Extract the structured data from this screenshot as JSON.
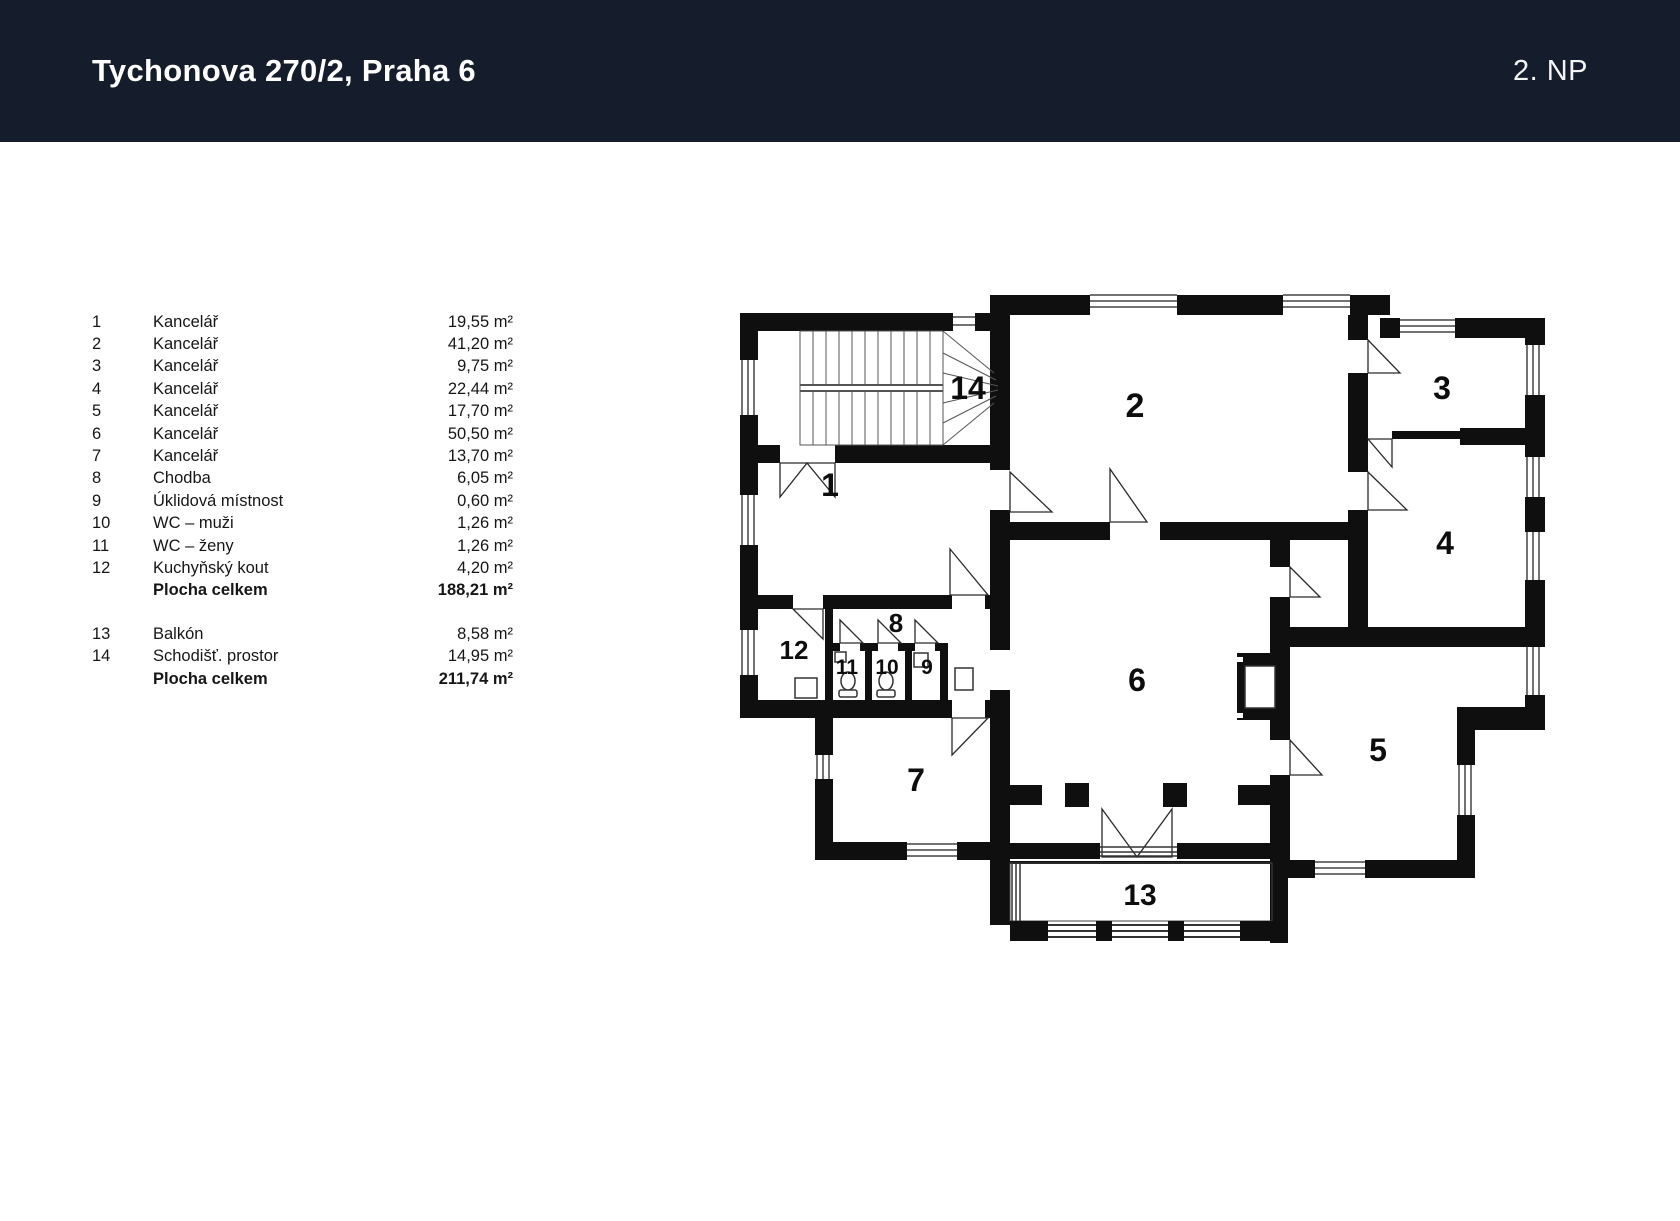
{
  "header": {
    "title": "Tychonova 270/2, Praha 6",
    "floor": "2. NP"
  },
  "legend": {
    "rows": [
      {
        "num": "1",
        "name": "Kancelář",
        "area": "19,55 m²"
      },
      {
        "num": "2",
        "name": "Kancelář",
        "area": "41,20 m²"
      },
      {
        "num": "3",
        "name": "Kancelář",
        "area": "9,75 m²"
      },
      {
        "num": "4",
        "name": "Kancelář",
        "area": "22,44 m²"
      },
      {
        "num": "5",
        "name": "Kancelář",
        "area": "17,70 m²"
      },
      {
        "num": "6",
        "name": "Kancelář",
        "area": "50,50 m²"
      },
      {
        "num": "7",
        "name": "Kancelář",
        "area": "13,70 m²"
      },
      {
        "num": "8",
        "name": "Chodba",
        "area": "6,05 m²"
      },
      {
        "num": "9",
        "name": "Úklidová místnost",
        "area": "0,60 m²"
      },
      {
        "num": "10",
        "name": "WC – muži",
        "area": "1,26 m²"
      },
      {
        "num": "11",
        "name": "WC – ženy",
        "area": "1,26 m²"
      },
      {
        "num": "12",
        "name": "Kuchyňský kout",
        "area": "4,20 m²"
      }
    ],
    "subtotal": {
      "label": "Plocha celkem",
      "area": "188,21 m²"
    },
    "rows2": [
      {
        "num": "13",
        "name": "Balkón",
        "area": "8,58 m²"
      },
      {
        "num": "14",
        "name": "Schodišť. prostor",
        "area": "14,95 m²"
      }
    ],
    "total": {
      "label": "Plocha celkem",
      "area": "211,74 m²"
    }
  },
  "plan": {
    "labels": {
      "r1": "1",
      "r2": "2",
      "r3": "3",
      "r4": "4",
      "r5": "5",
      "r6": "6",
      "r7": "7",
      "r8": "8",
      "r9": "9",
      "r10": "10",
      "r11": "11",
      "r12": "12",
      "r13": "13",
      "r14": "14"
    }
  }
}
